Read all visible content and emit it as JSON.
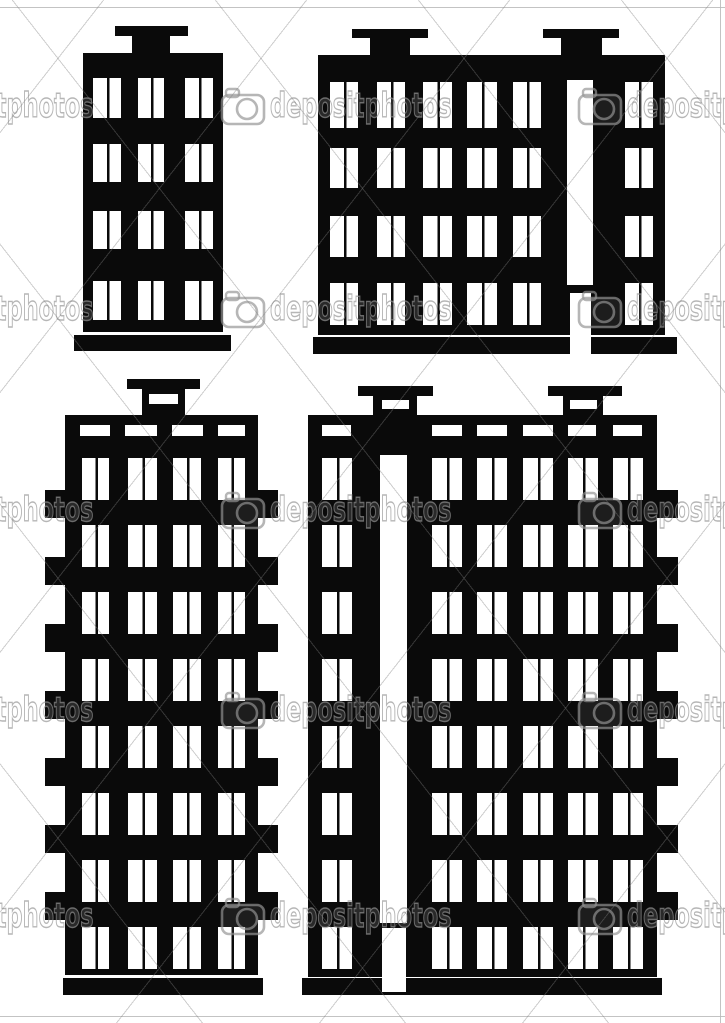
{
  "canvas": {
    "width": 725,
    "height": 1023,
    "background": "#ffffff",
    "ink": "#0a0a0a"
  },
  "watermark": {
    "text": "depositphotos",
    "icon": "camera-icon",
    "stroke_color": "rgba(148,148,148,0.68)",
    "rows_y": [
      106,
      309,
      510,
      710,
      916
    ],
    "units_x": [
      -88,
      270,
      627
    ],
    "icon_dx": -50,
    "border_lines": {
      "top_y": 7,
      "bottom_y": 1016,
      "right_x": 720
    }
  },
  "buildings": [
    {
      "name": "small-apartment-building",
      "body": [
        83,
        53,
        140,
        279
      ],
      "chimneys": [
        {
          "bar": [
            115,
            26,
            73,
            10
          ],
          "stem": [
            132,
            36,
            38,
            17
          ]
        }
      ],
      "base": [
        74,
        335,
        157,
        16
      ],
      "windows": {
        "cols": [
          {
            "x": 93,
            "w": 28
          },
          {
            "x": 138,
            "w": 26
          },
          {
            "x": 185,
            "w": 28
          }
        ],
        "rows": [
          {
            "y": 78,
            "h": 40
          },
          {
            "y": 144,
            "h": 38
          },
          {
            "y": 211,
            "h": 38
          },
          {
            "y": 281,
            "h": 39
          }
        ]
      }
    },
    {
      "name": "wide-apartment-building",
      "body": [
        318,
        55,
        347,
        280
      ],
      "chimneys": [
        {
          "bar": [
            352,
            29,
            76,
            9
          ],
          "stem": [
            370,
            38,
            40,
            17
          ]
        },
        {
          "bar": [
            543,
            29,
            76,
            9
          ],
          "stem": [
            561,
            38,
            41,
            17
          ]
        }
      ],
      "base": [
        313,
        337,
        364,
        17
      ],
      "stairwell_strip": [
        567,
        80,
        26,
        205
      ],
      "door": [
        570,
        293,
        21,
        62
      ],
      "windows": {
        "cols": [
          {
            "x": 330,
            "w": 28
          },
          {
            "x": 377,
            "w": 28
          },
          {
            "x": 423,
            "w": 29
          },
          {
            "x": 467,
            "w": 30
          },
          {
            "x": 513,
            "w": 28
          },
          {
            "x": 625,
            "w": 28
          }
        ],
        "rows": [
          {
            "y": 82,
            "h": 46
          },
          {
            "y": 148,
            "h": 40
          },
          {
            "y": 216,
            "h": 41
          },
          {
            "y": 283,
            "h": 42
          }
        ]
      }
    },
    {
      "name": "tall-apartment-building",
      "body": [
        65,
        415,
        193,
        560
      ],
      "chimneys": [
        {
          "bar": [
            127,
            379,
            73,
            10
          ],
          "stem": [
            142,
            389,
            43,
            26
          ],
          "slot": [
            149,
            394,
            29,
            10
          ]
        }
      ],
      "base": [
        63,
        978,
        200,
        17
      ],
      "vents": {
        "y": 425,
        "h": 11,
        "items": [
          [
            80,
            30
          ],
          [
            125,
            32
          ],
          [
            172,
            31
          ],
          [
            218,
            27
          ]
        ]
      },
      "windows": {
        "cols": [
          {
            "x": 82,
            "w": 27
          },
          {
            "x": 128,
            "w": 29
          },
          {
            "x": 173,
            "w": 28
          },
          {
            "x": 218,
            "w": 27
          }
        ],
        "rows": [
          {
            "y": 458,
            "h": 42
          },
          {
            "y": 525,
            "h": 42
          },
          {
            "y": 592,
            "h": 42
          },
          {
            "y": 659,
            "h": 42
          },
          {
            "y": 726,
            "h": 42
          },
          {
            "y": 793,
            "h": 42
          },
          {
            "y": 860,
            "h": 42
          },
          {
            "y": 927,
            "h": 42
          }
        ]
      },
      "bumps": {
        "w": 20,
        "h": 28,
        "left_x": 45,
        "right_x": 258,
        "ys": [
          490,
          557,
          624,
          691,
          758,
          825,
          892
        ]
      }
    },
    {
      "name": "large-apartment-building",
      "body": [
        308,
        415,
        349,
        562
      ],
      "chimneys": [
        {
          "bar": [
            358,
            386,
            75,
            10
          ],
          "stem": [
            373,
            396,
            44,
            19
          ],
          "slot": [
            382,
            400,
            27,
            9
          ]
        },
        {
          "bar": [
            548,
            386,
            74,
            10
          ],
          "stem": [
            563,
            396,
            40,
            19
          ],
          "slot": [
            570,
            400,
            27,
            9
          ]
        }
      ],
      "base": [
        302,
        978,
        360,
        17
      ],
      "vents": {
        "y": 425,
        "h": 11,
        "items": [
          [
            322,
            29
          ],
          [
            432,
            30
          ],
          [
            477,
            30
          ],
          [
            523,
            30
          ],
          [
            568,
            28
          ],
          [
            613,
            29
          ]
        ]
      },
      "stairwell_strip": [
        380,
        455,
        27,
        468
      ],
      "door": [
        382,
        928,
        24,
        64
      ],
      "windows": {
        "cols": [
          {
            "x": 322,
            "w": 30
          },
          {
            "x": 432,
            "w": 30
          },
          {
            "x": 477,
            "w": 30
          },
          {
            "x": 523,
            "w": 30
          },
          {
            "x": 568,
            "w": 30
          },
          {
            "x": 613,
            "w": 30
          }
        ],
        "rows": [
          {
            "y": 458,
            "h": 42
          },
          {
            "y": 525,
            "h": 42
          },
          {
            "y": 592,
            "h": 42
          },
          {
            "y": 659,
            "h": 42
          },
          {
            "y": 726,
            "h": 42
          },
          {
            "y": 793,
            "h": 42
          },
          {
            "y": 860,
            "h": 42
          },
          {
            "y": 927,
            "h": 42
          }
        ]
      },
      "bumps": {
        "w": 21,
        "h": 28,
        "right_x": 657,
        "ys": [
          490,
          557,
          624,
          691,
          758,
          825,
          892
        ]
      }
    }
  ]
}
